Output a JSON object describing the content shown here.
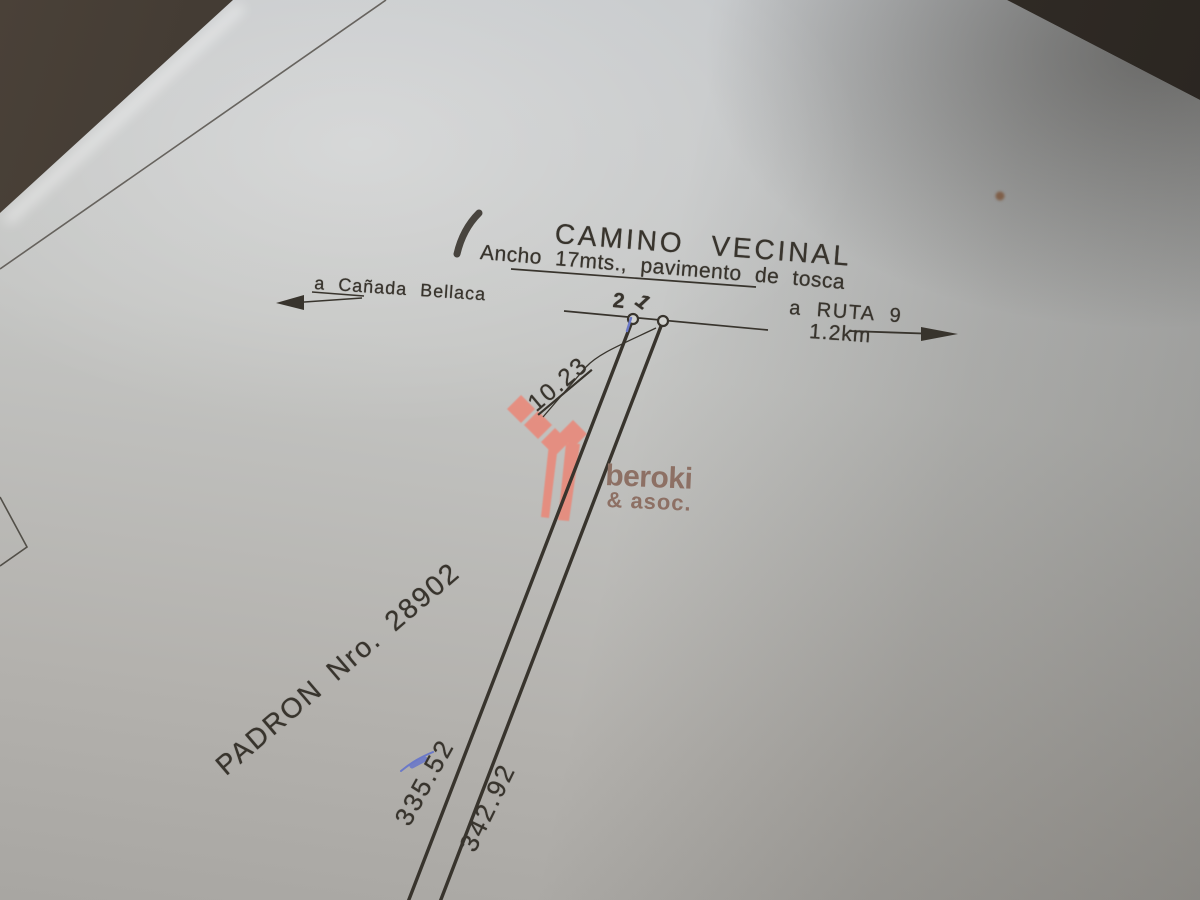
{
  "plan": {
    "title": "CAMINO VECINAL",
    "subtitle": "Ancho 17mts., pavimento de tosca",
    "left_direction": "a Cañada Bellaca",
    "right_direction": "a RUTA 9",
    "right_distance": "1.2km",
    "point_left": "2",
    "point_right": "1",
    "frontage_dimension": "10.23",
    "padron": "PADRON Nro. 28902",
    "side_west_dimension": "335.52",
    "side_east_dimension": "342.92"
  },
  "watermark": {
    "brand": "beroki",
    "suffix": "& asoc."
  },
  "colors": {
    "ink": "#38342d",
    "paper": "#c3c4c2",
    "background": "#38332c",
    "blue_mark": "#6b79c8",
    "red_speck": "#7a5236",
    "logo_red": "#ef8170",
    "logo_text": "#8d7064"
  }
}
